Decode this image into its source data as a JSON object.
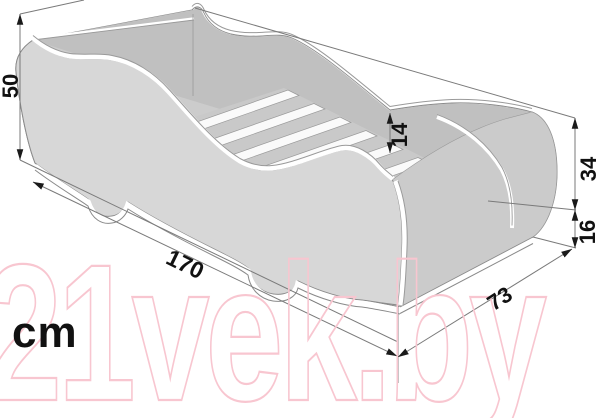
{
  "unit_label": "cm",
  "watermark": {
    "text": "21vek.by",
    "color": "#f8c6d0"
  },
  "dimensions": {
    "total_height": "50",
    "side_rail_depth": "14",
    "footboard_height": "34",
    "base_height": "16",
    "length": "170",
    "width": "73"
  },
  "colors": {
    "outline": "#8a8a8a",
    "panel_near": "#d7d7d7",
    "panel_far": "#c0c0c0",
    "platform": "#c9c9c9",
    "slat": "#fafafa",
    "dimension_text": "#111111",
    "watermark_pink": "#f8c6d0"
  }
}
